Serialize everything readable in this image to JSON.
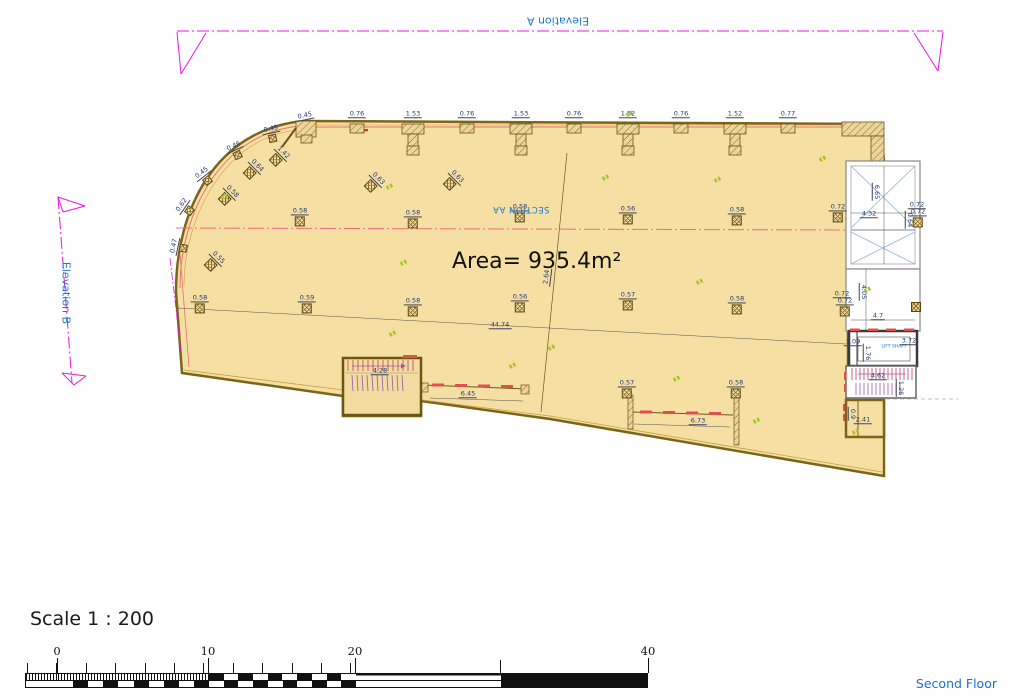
{
  "labels": {
    "elevation_a": "Elevation A",
    "elevation_b": "Elevation B",
    "section": "SECTION AA",
    "area": "Area= 935.4m²",
    "scale": "Scale 1 : 200",
    "floor": "Second Floor",
    "lift_shaft": "LIFT SHAFT"
  },
  "scale_bar": {
    "ticks": [
      {
        "label": "0",
        "x": 57
      },
      {
        "label": "10",
        "x": 208
      },
      {
        "label": "20",
        "x": 355
      },
      {
        "label": "40",
        "x": 648
      }
    ]
  },
  "plan": {
    "area_value": "935.4",
    "top_dimensions": [
      {
        "x": 357,
        "t": "0.76"
      },
      {
        "x": 413,
        "t": "1.53"
      },
      {
        "x": 467,
        "t": "0.76"
      },
      {
        "x": 521,
        "t": "1.53"
      },
      {
        "x": 574,
        "t": "0.76"
      },
      {
        "x": 628,
        "t": "1.52"
      },
      {
        "x": 681,
        "t": "0.76"
      },
      {
        "x": 735,
        "t": "1.52"
      },
      {
        "x": 788,
        "t": "0.77"
      }
    ],
    "columns": [
      {
        "x": 300,
        "y": 217,
        "t": "0.58"
      },
      {
        "x": 413,
        "y": 219,
        "t": "0.58"
      },
      {
        "x": 520,
        "y": 213,
        "t": "0.58"
      },
      {
        "x": 628,
        "y": 215,
        "t": "0.56"
      },
      {
        "x": 737,
        "y": 216,
        "t": "0.58"
      },
      {
        "x": 838,
        "y": 213,
        "t": "0.72"
      },
      {
        "x": 200,
        "y": 304,
        "t": "0.58"
      },
      {
        "x": 307,
        "y": 304,
        "t": "0.59"
      },
      {
        "x": 413,
        "y": 307,
        "t": "0.58"
      },
      {
        "x": 520,
        "y": 303,
        "t": "0.56"
      },
      {
        "x": 628,
        "y": 301,
        "t": "0.57"
      },
      {
        "x": 737,
        "y": 305,
        "t": "0.58"
      },
      {
        "x": 627,
        "y": 389,
        "t": "0.57"
      },
      {
        "x": 736,
        "y": 389,
        "t": "0.58"
      },
      {
        "x": 918,
        "y": 218,
        "t": "0.72"
      },
      {
        "x": 845,
        "y": 307,
        "t": "0.72"
      },
      {
        "x": 916,
        "y": 307,
        "t": ""
      }
    ],
    "rotated_columns": [
      {
        "x": 186,
        "y": 208,
        "r": -55,
        "t": "0.62",
        "s": 1
      },
      {
        "x": 179,
        "y": 247,
        "r": -78,
        "t": "0.47",
        "s": 1
      },
      {
        "x": 205,
        "y": 177,
        "r": -38,
        "t": "0.45",
        "s": 1
      },
      {
        "x": 236,
        "y": 151,
        "r": -25,
        "t": "0.46",
        "s": 1
      },
      {
        "x": 272,
        "y": 134,
        "r": -12,
        "t": "0.45",
        "s": 1
      },
      {
        "x": 214,
        "y": 262,
        "r": 45,
        "t": "0.55"
      },
      {
        "x": 228,
        "y": 196,
        "r": 45,
        "t": "0.58"
      },
      {
        "x": 253,
        "y": 170,
        "r": 45,
        "t": "0.64"
      },
      {
        "x": 279,
        "y": 157,
        "r": 45,
        "t": "1.42"
      },
      {
        "x": 374,
        "y": 183,
        "r": 45,
        "t": "0.63"
      },
      {
        "x": 453,
        "y": 181,
        "r": 45,
        "t": "0.63"
      }
    ],
    "dimensions": [
      {
        "x": 305,
        "y": 116,
        "t": "0.45",
        "r": -12
      },
      {
        "x": 876,
        "y": 192,
        "t": "6.65",
        "r": 90
      },
      {
        "x": 869,
        "y": 214,
        "t": "4.32"
      },
      {
        "x": 917,
        "y": 205,
        "t": "0.72"
      },
      {
        "x": 909,
        "y": 220,
        "t": "0.64",
        "r": 90
      },
      {
        "x": 863,
        "y": 292,
        "t": "4.05",
        "r": 90
      },
      {
        "x": 878,
        "y": 316,
        "t": "4.7"
      },
      {
        "x": 842,
        "y": 294,
        "t": "0.72"
      },
      {
        "x": 853,
        "y": 342,
        "t": "1.09"
      },
      {
        "x": 909,
        "y": 341,
        "t": "3.72"
      },
      {
        "x": 867,
        "y": 353,
        "t": "1.76",
        "r": 90
      },
      {
        "x": 878,
        "y": 376,
        "t": "4.62"
      },
      {
        "x": 900,
        "y": 388,
        "t": "1.26",
        "r": 90
      },
      {
        "x": 863,
        "y": 420,
        "t": "2.41"
      },
      {
        "x": 852,
        "y": 414,
        "t": "0.9",
        "r": 90
      },
      {
        "x": 380,
        "y": 371,
        "t": "4.28"
      },
      {
        "x": 468,
        "y": 394,
        "t": "6.45"
      },
      {
        "x": 698,
        "y": 421,
        "t": "6.73"
      },
      {
        "x": 500,
        "y": 325,
        "t": "44.74"
      },
      {
        "x": 547,
        "y": 277,
        "t": "2.64",
        "r": -83
      }
    ],
    "piers_small": [
      357,
      467,
      574,
      681,
      788
    ],
    "piers_large": [
      413,
      521,
      628,
      735
    ],
    "green_marks": [
      [
        630,
        113
      ],
      [
        718,
        179
      ],
      [
        606,
        177
      ],
      [
        390,
        186
      ],
      [
        225,
        196
      ],
      [
        404,
        262
      ],
      [
        700,
        281
      ],
      [
        552,
        347
      ],
      [
        393,
        333
      ],
      [
        513,
        365
      ],
      [
        677,
        378
      ],
      [
        757,
        420
      ],
      [
        856,
        431
      ],
      [
        823,
        158
      ],
      [
        868,
        289
      ]
    ]
  },
  "colors": {
    "floor_fill": "#f6dfa3",
    "wall_stroke": "#7a651a",
    "accent_salmon": "#e87070",
    "accent_orange": "#d89a30",
    "magenta": "#e816e8",
    "section_pink": "#ea6e7a",
    "blue_text": "#1b6fd6",
    "dim_text": "#1e3a78",
    "xline_blue": "#92b4dc",
    "stair_red": "#c43b5c",
    "stair_purple": "#9a5aaa",
    "window_red": "#e05050",
    "green_mark": "#a9c428"
  }
}
